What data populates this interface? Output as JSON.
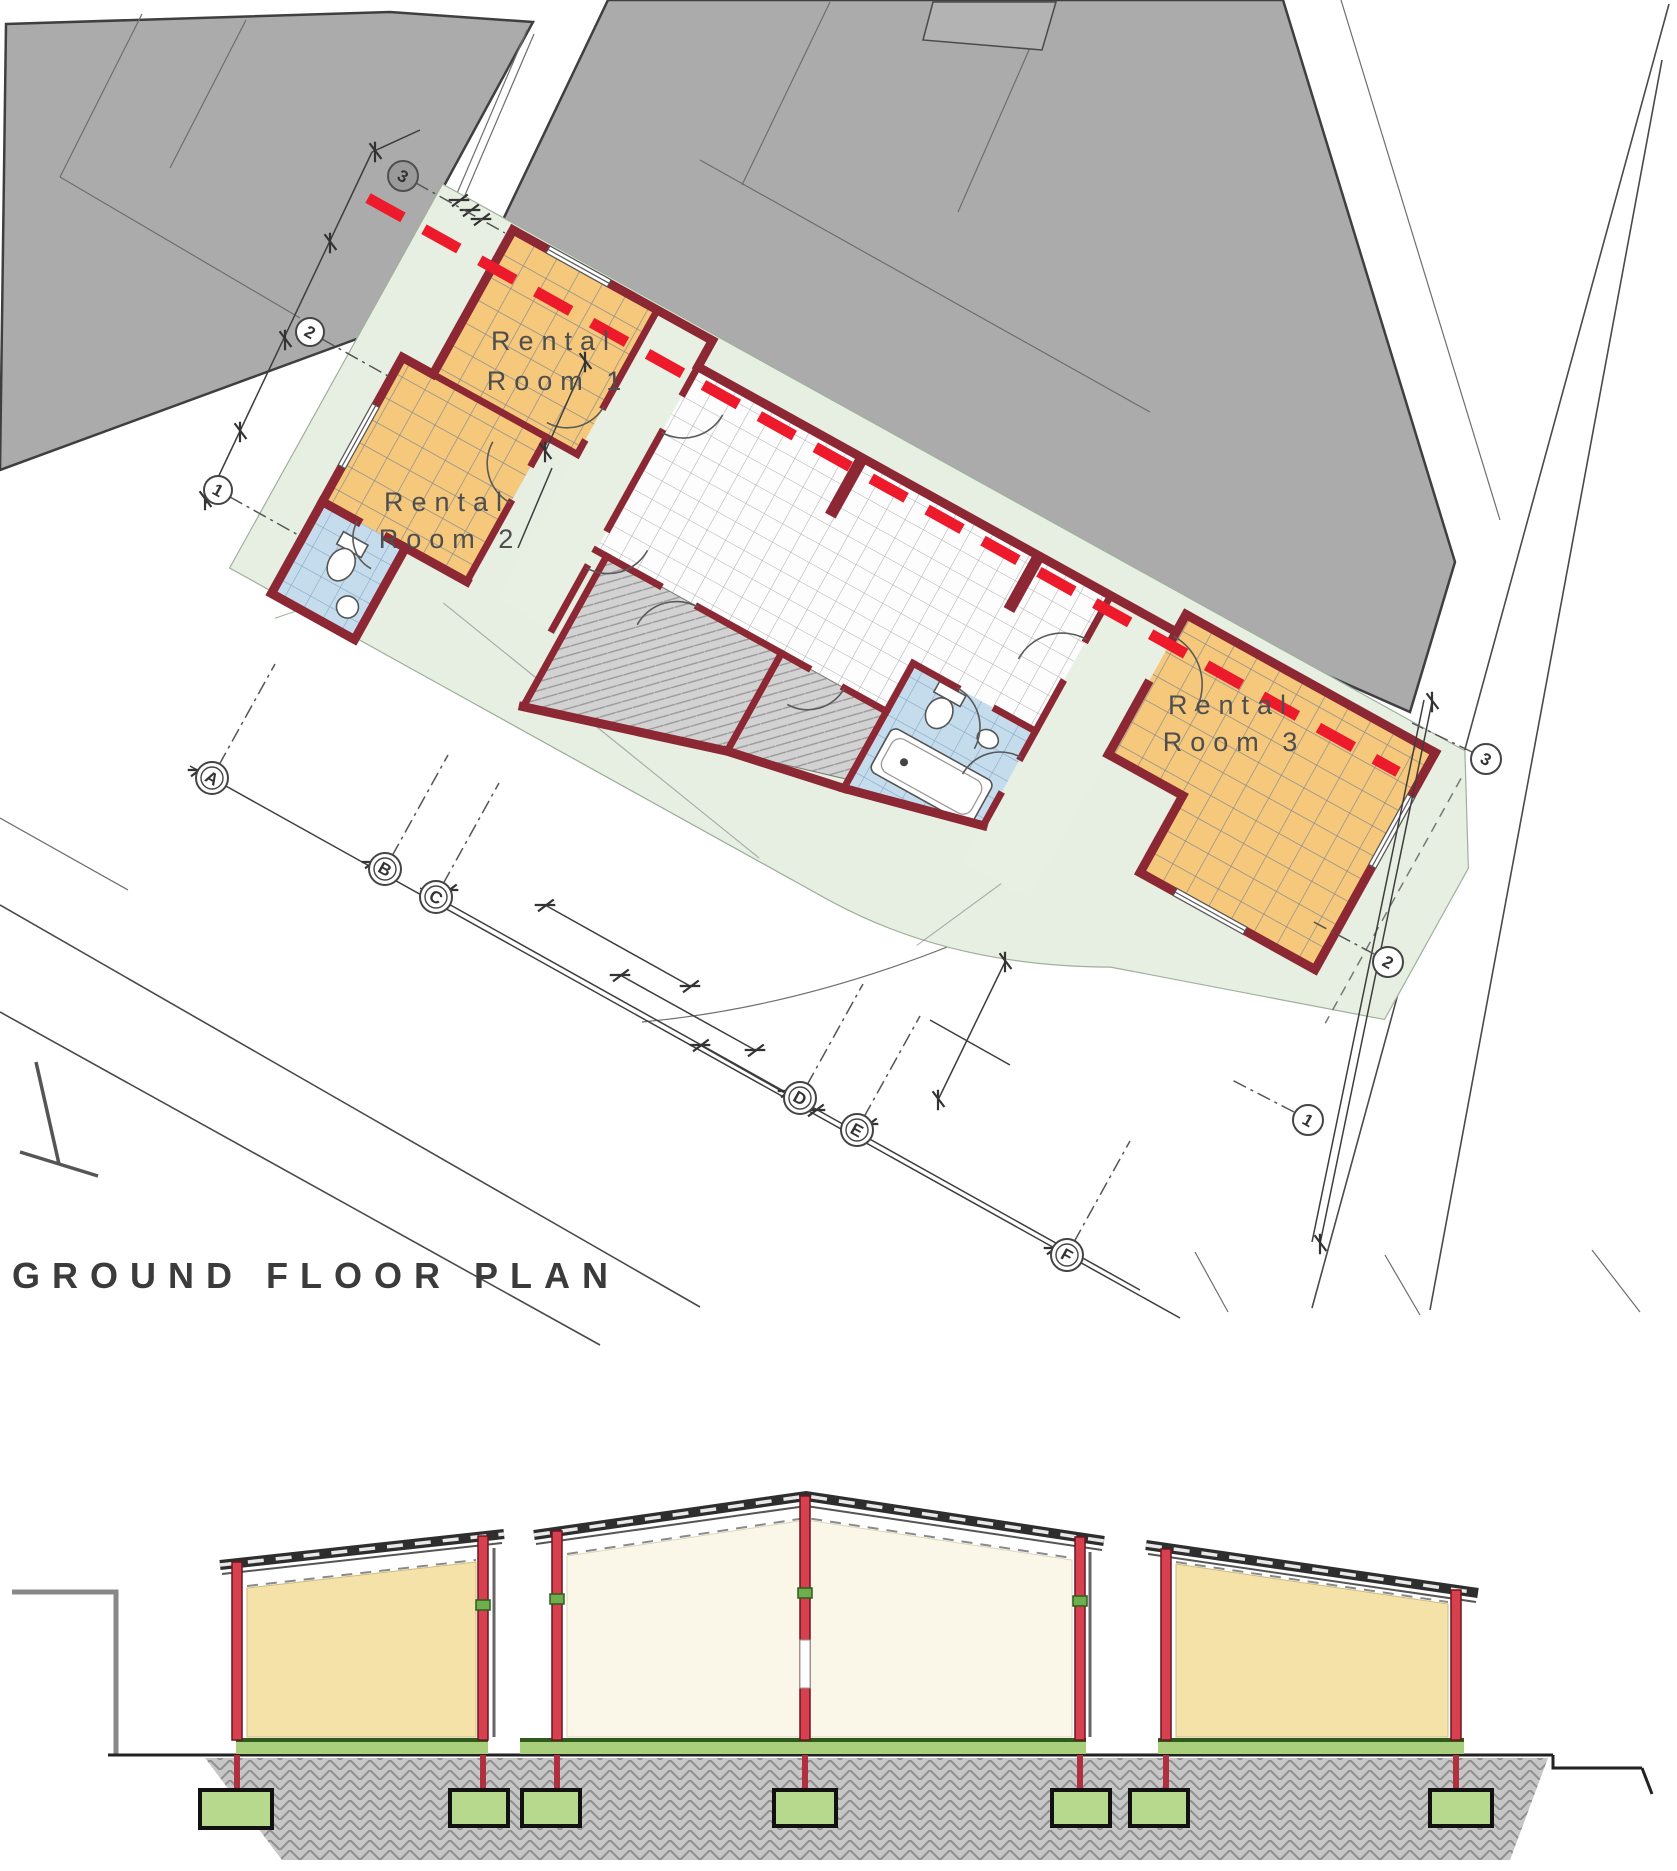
{
  "page": {
    "title": "GROUND FLOOR PLAN"
  },
  "plan": {
    "rooms": [
      {
        "line1": "Rental",
        "line2": "Room 1"
      },
      {
        "line1": "Rental",
        "line2": "Room 2"
      },
      {
        "line1": "Rental",
        "line2": "Room 3"
      }
    ],
    "bubbles": [
      "3",
      "2",
      "1",
      "A",
      "B",
      "C",
      "D",
      "E",
      "F",
      "3",
      "2",
      "1"
    ],
    "section_line": {
      "style": "red-dashed"
    }
  },
  "colors": {
    "room_fill": "#f5c87c",
    "tile_white": "#fdfdfd",
    "bath_blue": "#c5dced",
    "wall_red": "#8c2833",
    "section_line_red": "#ec1a2b",
    "terrace_green": "#e7efe2",
    "neighbor_gray": "#ababab",
    "ground_gray": "#c8c8c8",
    "footing_green": "#b7d98e",
    "slab_green": "#a9cf7c",
    "column_red": "#d6404f",
    "panel_yellow": "#f5e2a9",
    "panel_cream": "#faf6e8"
  }
}
